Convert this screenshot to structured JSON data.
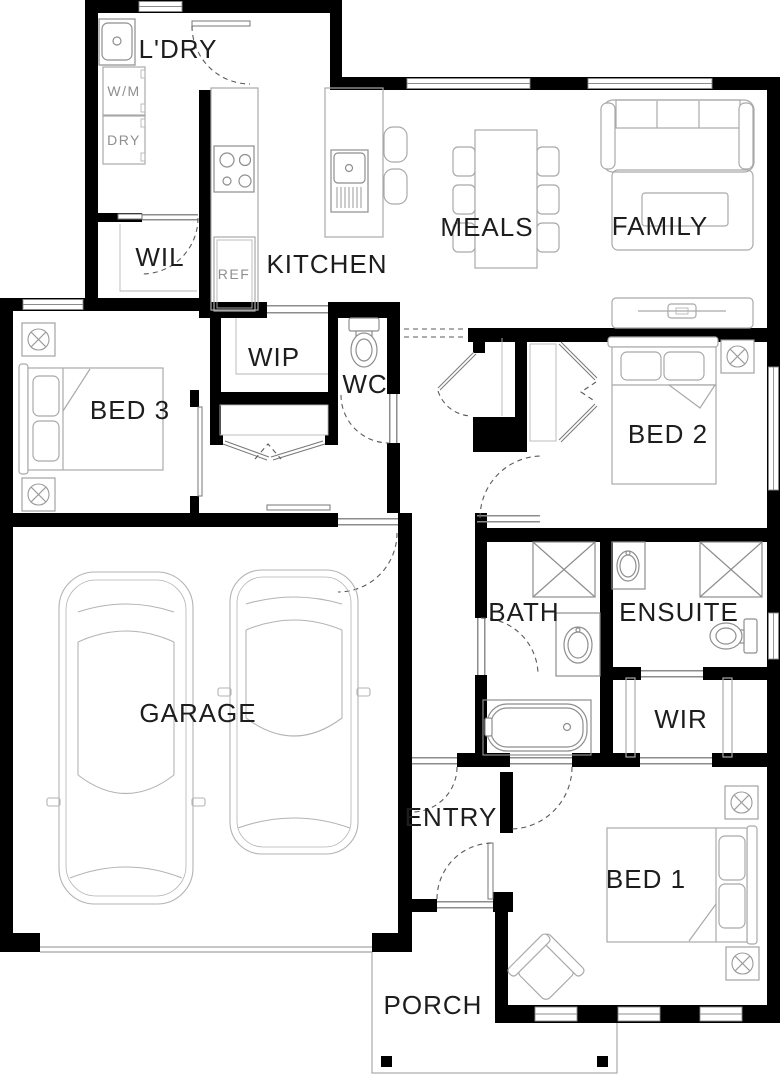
{
  "plan": {
    "type": "residential-floor-plan",
    "rooms": [
      {
        "id": "laundry",
        "label": "L'DRY"
      },
      {
        "id": "walk-in-linen",
        "label": "WIL"
      },
      {
        "id": "kitchen",
        "label": "KITCHEN"
      },
      {
        "id": "walk-in-pantry",
        "label": "WIP"
      },
      {
        "id": "wc",
        "label": "WC"
      },
      {
        "id": "meals",
        "label": "MEALS"
      },
      {
        "id": "family",
        "label": "FAMILY"
      },
      {
        "id": "bed-3",
        "label": "BED 3"
      },
      {
        "id": "bed-2",
        "label": "BED 2"
      },
      {
        "id": "bath",
        "label": "BATH"
      },
      {
        "id": "ensuite",
        "label": "ENSUITE"
      },
      {
        "id": "garage",
        "label": "GARAGE"
      },
      {
        "id": "walk-in-robe",
        "label": "WIR"
      },
      {
        "id": "entry",
        "label": "ENTRY"
      },
      {
        "id": "bed-1",
        "label": "BED 1"
      },
      {
        "id": "porch",
        "label": "PORCH"
      }
    ],
    "appliances": {
      "washer": "W/M",
      "dryer": "DRY",
      "fridge": "REF"
    },
    "colors": {
      "wall": "#000000",
      "background": "#ffffff",
      "furniture_line": "#a9a9a9",
      "fixture_line": "#8e8e8e",
      "label_text": "#1d1d1d",
      "appliance_text": "#8f8f8f",
      "door_arc": "#5a5a5a"
    }
  }
}
